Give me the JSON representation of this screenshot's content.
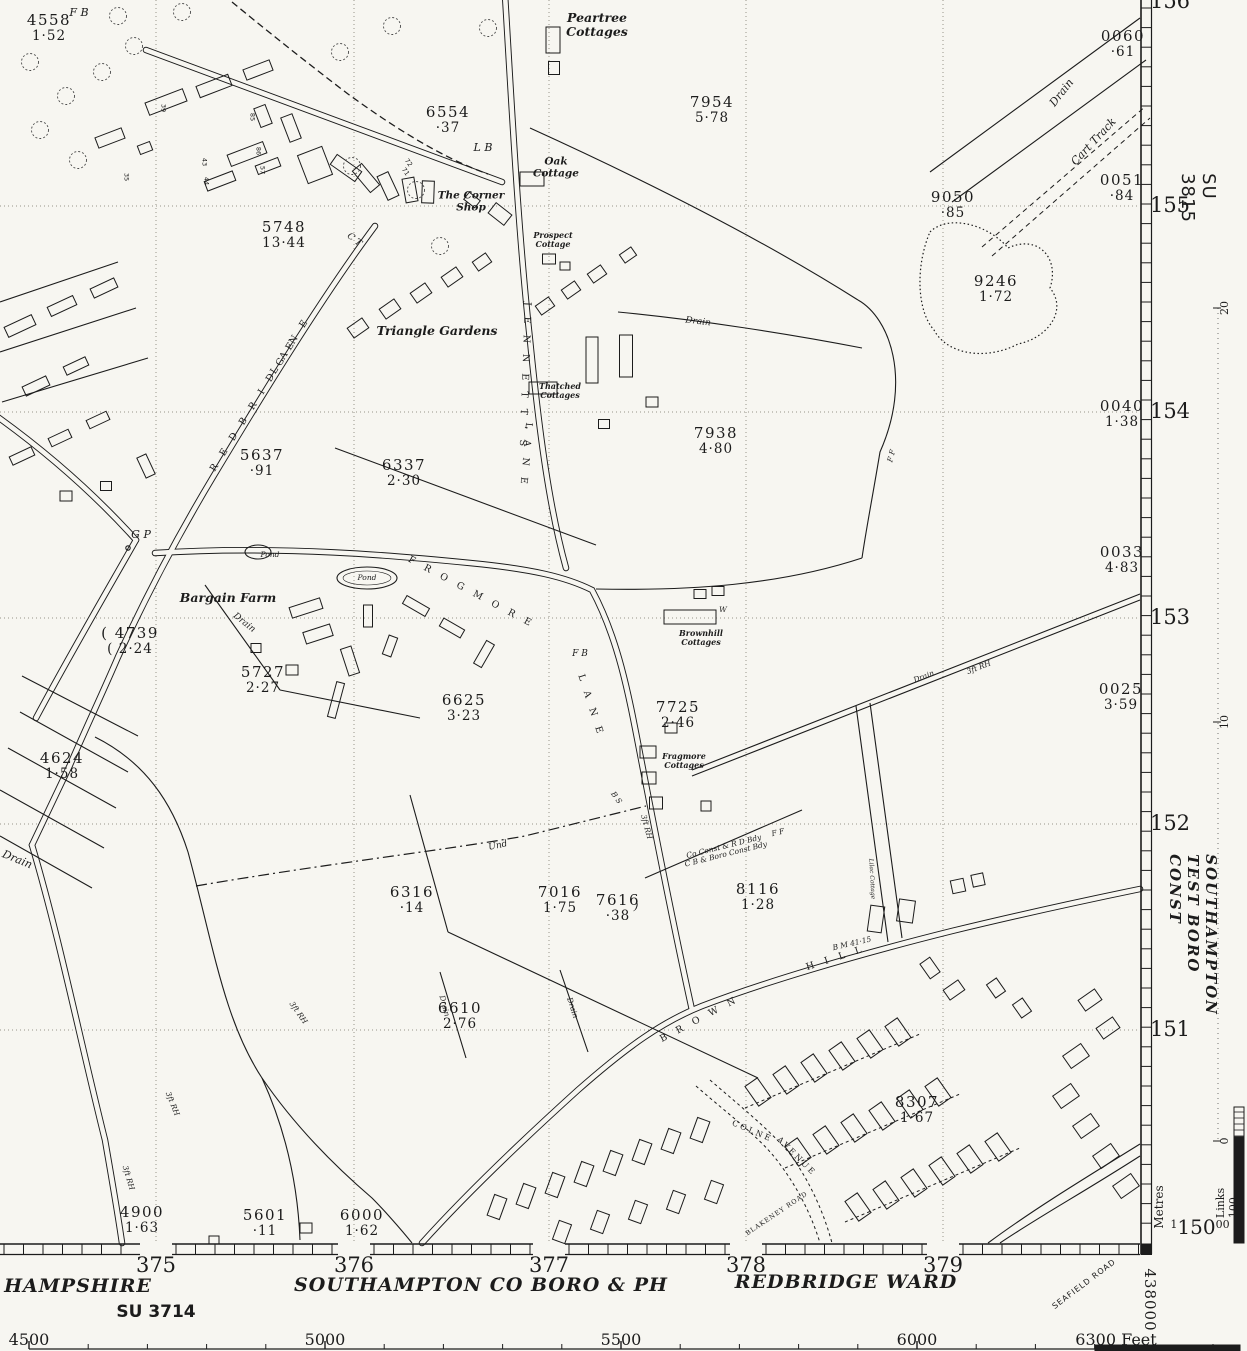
{
  "map_sheet": {
    "right_margin": {
      "sheet_ref": "SU 3815",
      "constituency": "SOUTHAMPTON TEST BORO CONST",
      "metres_caption": "Metres",
      "links_caption": "Links 100",
      "corner_northing": {
        "prefix": "1",
        "main": "150",
        "suffix": "00"
      },
      "northings": [
        {
          "v": "156",
          "y": 2
        },
        {
          "v": "155",
          "y": 206
        },
        {
          "v": "154",
          "y": 412
        },
        {
          "v": "153",
          "y": 618
        },
        {
          "v": "152",
          "y": 824
        },
        {
          "v": "151",
          "y": 1030
        }
      ],
      "metre_marks": [
        {
          "v": "20",
          "y": 308
        },
        {
          "v": "10",
          "y": 722
        },
        {
          "v": "0",
          "y": 1141
        }
      ]
    },
    "bottom_margin": {
      "county": "HAMPSHIRE",
      "sheet_ref": "SU 3714",
      "borough": "SOUTHAMPTON CO BORO & PH",
      "ward": "REDBRIDGE WARD",
      "road": "SEAFIELD ROAD",
      "corner_easting": "438000",
      "eastings": [
        {
          "v": "375",
          "x": 156
        },
        {
          "v": "376",
          "x": 354
        },
        {
          "v": "377",
          "x": 549
        },
        {
          "v": "378",
          "x": 746
        },
        {
          "v": "379",
          "x": 943
        }
      ],
      "feet_labels": [
        {
          "v": "4500",
          "x": 29
        },
        {
          "v": "5000",
          "x": 325
        },
        {
          "v": "5500",
          "x": 621
        },
        {
          "v": "6000",
          "x": 917
        },
        {
          "v": "6300 Feet",
          "x": 1116
        }
      ]
    },
    "parcels": [
      {
        "no": "4558",
        "area": "1·52",
        "x": 49,
        "y": 28
      },
      {
        "no": "6554",
        "area": "·37",
        "x": 448,
        "y": 120
      },
      {
        "no": "7954",
        "area": "5·78",
        "x": 712,
        "y": 110
      },
      {
        "no": "9050",
        "area": "·85",
        "x": 953,
        "y": 205
      },
      {
        "no": "0060",
        "area": "·61",
        "x": 1123,
        "y": 44
      },
      {
        "no": "0051",
        "area": "·84",
        "x": 1122,
        "y": 188
      },
      {
        "no": "5748",
        "area": "13·44",
        "x": 284,
        "y": 235
      },
      {
        "no": "9246",
        "area": "1·72",
        "x": 996,
        "y": 289
      },
      {
        "no": "0040",
        "area": "1·38",
        "x": 1122,
        "y": 414
      },
      {
        "no": "5637",
        "area": "·91",
        "x": 262,
        "y": 463
      },
      {
        "no": "6337",
        "area": "2·30",
        "x": 404,
        "y": 473
      },
      {
        "no": "7938",
        "area": "4·80",
        "x": 716,
        "y": 441
      },
      {
        "no": "0033",
        "area": "4·83",
        "x": 1122,
        "y": 560
      },
      {
        "no": "4739",
        "area": "2·24",
        "x": 130,
        "y": 641,
        "paren": true
      },
      {
        "no": "5727",
        "area": "2·27",
        "x": 263,
        "y": 680
      },
      {
        "no": "6625",
        "area": "3·23",
        "x": 464,
        "y": 708
      },
      {
        "no": "7725",
        "area": "2·46",
        "x": 678,
        "y": 715
      },
      {
        "no": "0025",
        "area": "3·59",
        "x": 1121,
        "y": 697
      },
      {
        "no": "4624",
        "area": "1·58",
        "x": 62,
        "y": 766
      },
      {
        "no": "6316",
        "area": "·14",
        "x": 412,
        "y": 900
      },
      {
        "no": "7016",
        "area": "1·75",
        "x": 560,
        "y": 900
      },
      {
        "no": "7616",
        "area": "·38",
        "x": 618,
        "y": 908
      },
      {
        "no": "8116",
        "area": "1·28",
        "x": 758,
        "y": 897
      },
      {
        "no": "6610",
        "area": "2·76",
        "x": 460,
        "y": 1016
      },
      {
        "no": "8307",
        "area": "1·67",
        "x": 917,
        "y": 1110
      },
      {
        "no": "4900",
        "area": "1·63",
        "x": 142,
        "y": 1220
      },
      {
        "no": "5601",
        "area": "·11",
        "x": 265,
        "y": 1223
      },
      {
        "no": "6000",
        "area": "1·62",
        "x": 362,
        "y": 1223
      }
    ],
    "places": [
      {
        "t": "F B",
        "x": 79,
        "y": 13,
        "r": 0,
        "c": "feat"
      },
      {
        "t": "Peartree\nCottages",
        "x": 597,
        "y": 25,
        "r": 0,
        "c": "name"
      },
      {
        "t": "L B",
        "x": 483,
        "y": 148,
        "r": 0,
        "c": "feat"
      },
      {
        "t": "Oak\nCottage",
        "x": 556,
        "y": 168,
        "r": 0,
        "c": "name-sm"
      },
      {
        "t": "The Corner\nShop",
        "x": 471,
        "y": 202,
        "r": 0,
        "c": "name-sm"
      },
      {
        "t": "Prospect\nCottage",
        "x": 553,
        "y": 240,
        "r": 0,
        "c": "name-xs"
      },
      {
        "t": "Drain",
        "x": 1062,
        "y": 93,
        "r": -52,
        "c": "feat"
      },
      {
        "t": "Cart Track",
        "x": 1094,
        "y": 142,
        "r": -47,
        "c": "feat"
      },
      {
        "t": "C T",
        "x": 354,
        "y": 240,
        "r": 38,
        "c": "feat-sm"
      },
      {
        "t": "Triangle Gardens",
        "x": 437,
        "y": 331,
        "r": 0,
        "c": "name"
      },
      {
        "t": "Thatched\nCottages",
        "x": 560,
        "y": 391,
        "r": 0,
        "c": "name-xs"
      },
      {
        "t": "Drain",
        "x": 698,
        "y": 322,
        "r": 7,
        "c": "feat-sm"
      },
      {
        "t": "F F",
        "x": 892,
        "y": 456,
        "r": -75,
        "c": "feat-xs"
      },
      {
        "t": "G P",
        "x": 141,
        "y": 535,
        "r": 0,
        "c": "feat"
      },
      {
        "t": "Bargain Farm",
        "x": 228,
        "y": 598,
        "r": 0,
        "c": "name"
      },
      {
        "t": "Pond",
        "x": 270,
        "y": 555,
        "r": 0,
        "c": "feat-xs"
      },
      {
        "t": "Pond",
        "x": 367,
        "y": 578,
        "r": 0,
        "c": "feat-xs"
      },
      {
        "t": "Drain",
        "x": 244,
        "y": 623,
        "r": 38,
        "c": "feat-sm"
      },
      {
        "t": "Brownhill\nCottages",
        "x": 701,
        "y": 638,
        "r": 0,
        "c": "name-xs"
      },
      {
        "t": "W",
        "x": 723,
        "y": 610,
        "r": 0,
        "c": "feat-xs"
      },
      {
        "t": "F B",
        "x": 580,
        "y": 654,
        "r": 0,
        "c": "feat-sm"
      },
      {
        "t": "Fragmore\nCottages",
        "x": 684,
        "y": 761,
        "r": 0,
        "c": "name-xs"
      },
      {
        "t": "Drain",
        "x": 924,
        "y": 677,
        "r": -21,
        "c": "feat-xs"
      },
      {
        "t": "3ft RH",
        "x": 979,
        "y": 668,
        "r": -21,
        "c": "feat-xs"
      },
      {
        "t": "Drain",
        "x": 17,
        "y": 860,
        "r": 22,
        "c": "feat"
      },
      {
        "t": "Und",
        "x": 498,
        "y": 846,
        "r": -12,
        "c": "feat-sm"
      },
      {
        "t": "B S",
        "x": 616,
        "y": 798,
        "r": 55,
        "c": "feat-xs"
      },
      {
        "t": "3ft RH",
        "x": 646,
        "y": 827,
        "r": 75,
        "c": "feat-xs"
      },
      {
        "t": "Co Const & R D Bdy\nC B & Boro Const Bdy",
        "x": 725,
        "y": 851,
        "r": -14,
        "c": "feat-xs"
      },
      {
        "t": "F F",
        "x": 778,
        "y": 833,
        "r": -14,
        "c": "feat-xs"
      },
      {
        "t": "B M 41·15",
        "x": 852,
        "y": 944,
        "r": -13,
        "c": "feat-xs"
      },
      {
        "t": "Lilac Cottage",
        "x": 871,
        "y": 879,
        "r": 87,
        "c": "feat-xxs"
      },
      {
        "t": ")",
        "x": 636,
        "y": 907,
        "r": 5,
        "c": "feat"
      },
      {
        "t": "Drain",
        "x": 444,
        "y": 1006,
        "r": 75,
        "c": "feat-xs"
      },
      {
        "t": "Drain",
        "x": 572,
        "y": 1008,
        "r": 72,
        "c": "feat-xs"
      },
      {
        "t": "3ft RH",
        "x": 298,
        "y": 1013,
        "r": 55,
        "c": "feat-xs"
      },
      {
        "t": "3ft RH",
        "x": 172,
        "y": 1104,
        "r": 68,
        "c": "feat-xs"
      },
      {
        "t": "3ft RH",
        "x": 128,
        "y": 1178,
        "r": 73,
        "c": "feat-xs"
      }
    ],
    "road_names": [
      {
        "t": "L A N E",
        "x": 291,
        "y": 346,
        "r": -58,
        "c": "road"
      },
      {
        "t": "R E D B R I D G E",
        "x": 254,
        "y": 406,
        "r": -58,
        "c": "road"
      },
      {
        "t": "J E N N E T T ' S",
        "x": 524,
        "y": 376,
        "r": 92,
        "c": "road"
      },
      {
        "t": "L A N E",
        "x": 525,
        "y": 455,
        "r": 95,
        "c": "road"
      },
      {
        "t": "F R O G M O R E",
        "x": 471,
        "y": 593,
        "r": 28,
        "c": "road"
      },
      {
        "t": "L A N E",
        "x": 590,
        "y": 706,
        "r": 72,
        "c": "road"
      },
      {
        "t": "B R O W N",
        "x": 700,
        "y": 1020,
        "r": -28,
        "c": "road"
      },
      {
        "t": "H I L L",
        "x": 836,
        "y": 959,
        "r": -18,
        "c": "road"
      },
      {
        "t": "COLNE",
        "x": 752,
        "y": 1132,
        "r": 23,
        "c": "road-sm"
      },
      {
        "t": "AVENUE",
        "x": 796,
        "y": 1157,
        "r": 45,
        "c": "road-sm"
      },
      {
        "t": "BLAKENEY ROAD",
        "x": 777,
        "y": 1214,
        "r": -34,
        "c": "road-xs"
      }
    ],
    "house_numbers": [
      {
        "t": "39",
        "x": 163,
        "y": 108,
        "r": 90
      },
      {
        "t": "35",
        "x": 126,
        "y": 177,
        "r": 90
      },
      {
        "t": "43",
        "x": 204,
        "y": 162,
        "r": 90
      },
      {
        "t": "44",
        "x": 206,
        "y": 181,
        "r": 90
      },
      {
        "t": "85",
        "x": 252,
        "y": 117,
        "r": 90
      },
      {
        "t": "86",
        "x": 258,
        "y": 151,
        "r": 90
      },
      {
        "t": "57",
        "x": 262,
        "y": 170,
        "r": 90
      },
      {
        "t": "72",
        "x": 408,
        "y": 163,
        "r": 55
      },
      {
        "t": "71",
        "x": 405,
        "y": 172,
        "r": 55
      }
    ]
  }
}
